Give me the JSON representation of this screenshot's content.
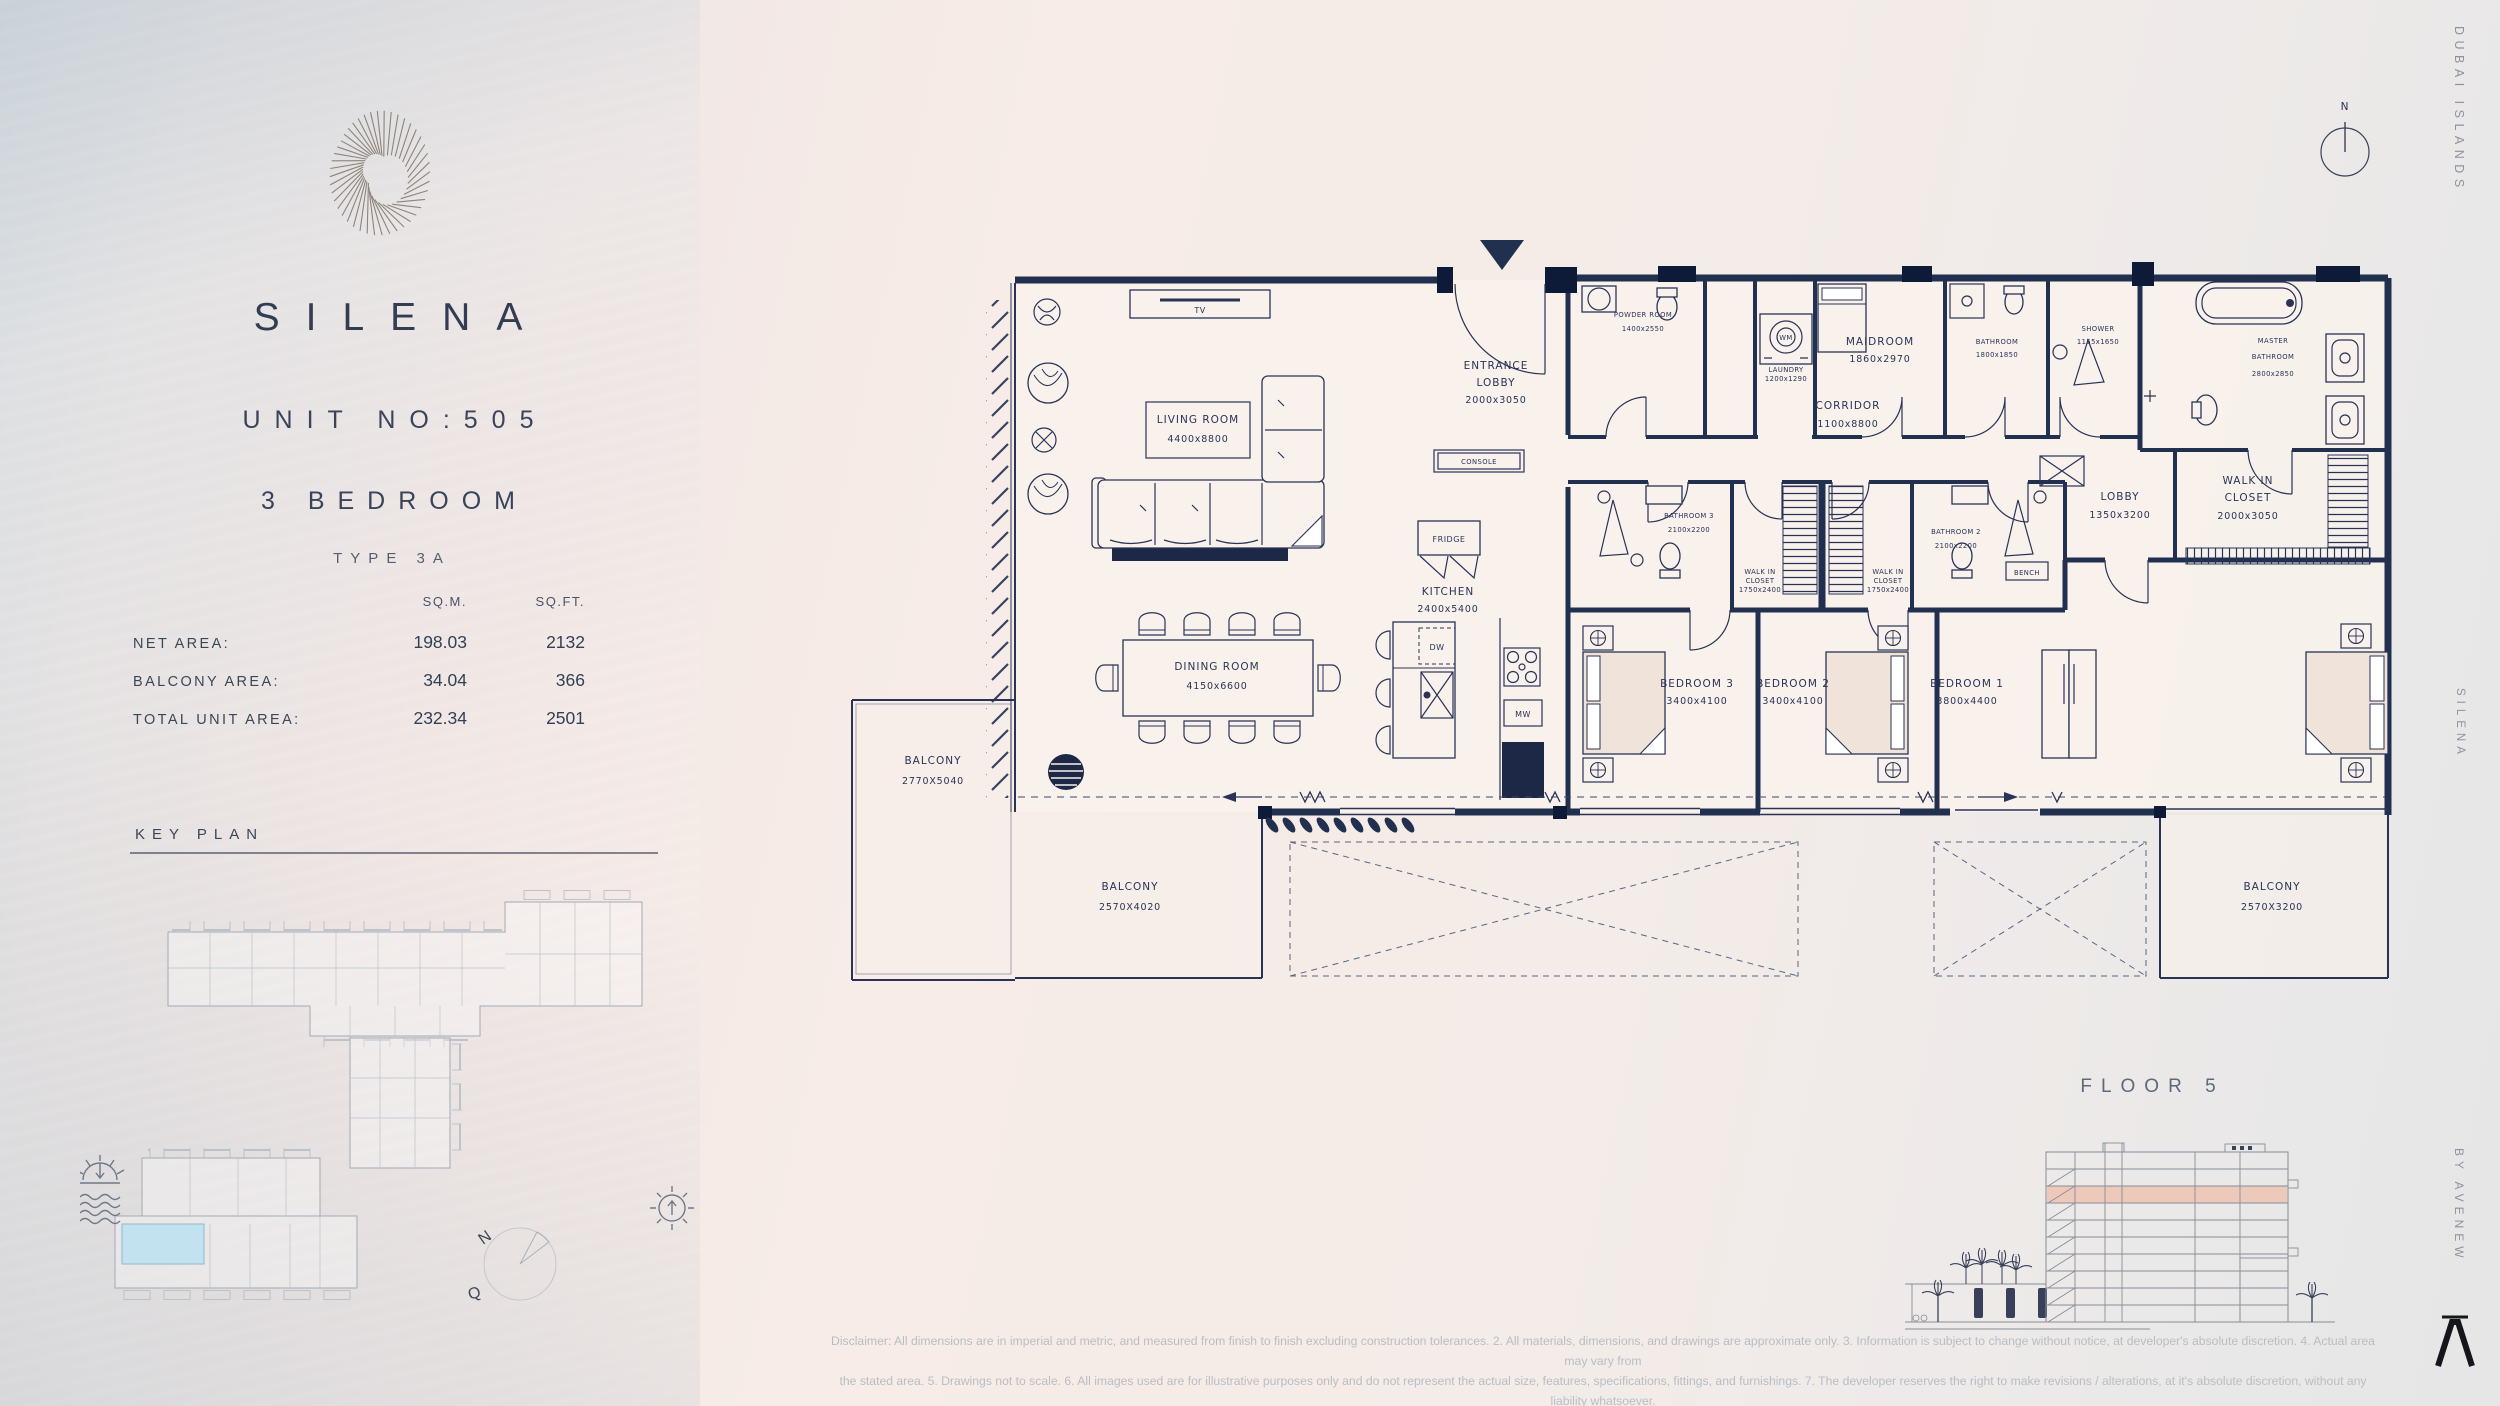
{
  "left_panel": {
    "title": "SILENA",
    "unit": "UNIT NO:505",
    "bedrooms": "3 BEDROOM",
    "type": "TYPE 3A",
    "table": {
      "col_sqm": "SQ.M.",
      "col_sqft": "SQ.FT.",
      "rows": [
        {
          "label": "NET AREA:",
          "sqm": "198.03",
          "sqft": "2132"
        },
        {
          "label": "BALCONY AREA:",
          "sqm": "34.04",
          "sqft": "366"
        },
        {
          "label": "TOTAL UNIT AREA:",
          "sqm": "232.34",
          "sqft": "2501"
        }
      ]
    },
    "key_plan_title": "KEY PLAN",
    "key_plan_compass": {
      "n": "N",
      "q": "Q"
    }
  },
  "plan": {
    "north_label": "N",
    "rooms": [
      {
        "l1": "LIVING ROOM",
        "l2": "4400x8800"
      },
      {
        "l1": "DINING ROOM",
        "l2": "4150x6600"
      },
      {
        "l1": "ENTRANCE",
        "l2": "LOBBY",
        "l3": "2000x3050"
      },
      {
        "l1": "KITCHEN",
        "l2": "2400x5400"
      },
      {
        "l1": "POWDER ROOM",
        "l2": "1400x2550"
      },
      {
        "l1": "LAUNDRY",
        "l2": "1200x1290"
      },
      {
        "l1": "MAIDROOM",
        "l2": "1860x2970"
      },
      {
        "l1": "BATHROOM",
        "l2": "1800x1850"
      },
      {
        "l1": "SHOWER",
        "l2": "1155x1650"
      },
      {
        "l1": "MASTER",
        "l2": "BATHROOM",
        "l3": "2800x2850"
      },
      {
        "l1": "CORRIDOR",
        "l2": "1100x8800"
      },
      {
        "l1": "BATHROOM 3",
        "l2": "2100x2200"
      },
      {
        "l1": "WALK IN",
        "l2": "CLOSET",
        "l3": "1750x2400"
      },
      {
        "l1": "WALK IN",
        "l2": "CLOSET",
        "l3": "1750x2400"
      },
      {
        "l1": "BATHROOM 2",
        "l2": "2100x2200"
      },
      {
        "l1": "LOBBY",
        "l2": "1350x3200"
      },
      {
        "l1": "WALK IN",
        "l2": "CLOSET",
        "l3": "2000x3050"
      },
      {
        "l1": "BEDROOM 3",
        "l2": "3400x4100"
      },
      {
        "l1": "BEDROOM 2",
        "l2": "3400x4100"
      },
      {
        "l1": "BEDROOM 1",
        "l2": "3800x4400"
      },
      {
        "l1": "BALCONY",
        "l2": "2770X5040"
      },
      {
        "l1": "BALCONY",
        "l2": "2570X4020"
      },
      {
        "l1": "BALCONY",
        "l2": "2570X3200"
      }
    ],
    "fixtures": {
      "tv": "TV",
      "wm": "WM",
      "dw": "DW",
      "mw": "MW",
      "fridge": "FRIDGE",
      "console": "CONSOLE",
      "bench": "BENCH"
    }
  },
  "footer": {
    "floor": "FLOOR 5",
    "disclaimer1": "Disclaimer: All dimensions are in imperial and metric, and measured from finish to finish excluding construction tolerances. 2. All materials, dimensions, and drawings are approximate only. 3. Information is subject to change without notice, at developer's absolute discretion. 4. Actual area may vary from",
    "disclaimer2": "the stated area. 5. Drawings not to scale. 6. All images used are for illustrative purposes only and do not represent the actual size, features, specifications, fittings, and furnishings. 7. The developer reserves the right to make revisions / alterations, at it's absolute discretion, without any liability whatsoever."
  },
  "side_texts": {
    "top": "DUBAI ISLANDS",
    "middle": "SILENA",
    "bottom": "BY AVENEW"
  },
  "colors": {
    "navy": "#2a3356",
    "wall": "#22304f",
    "highlight": "#edc3b1",
    "pool": "#c3e2f0",
    "muted": "#9aa2ae"
  }
}
